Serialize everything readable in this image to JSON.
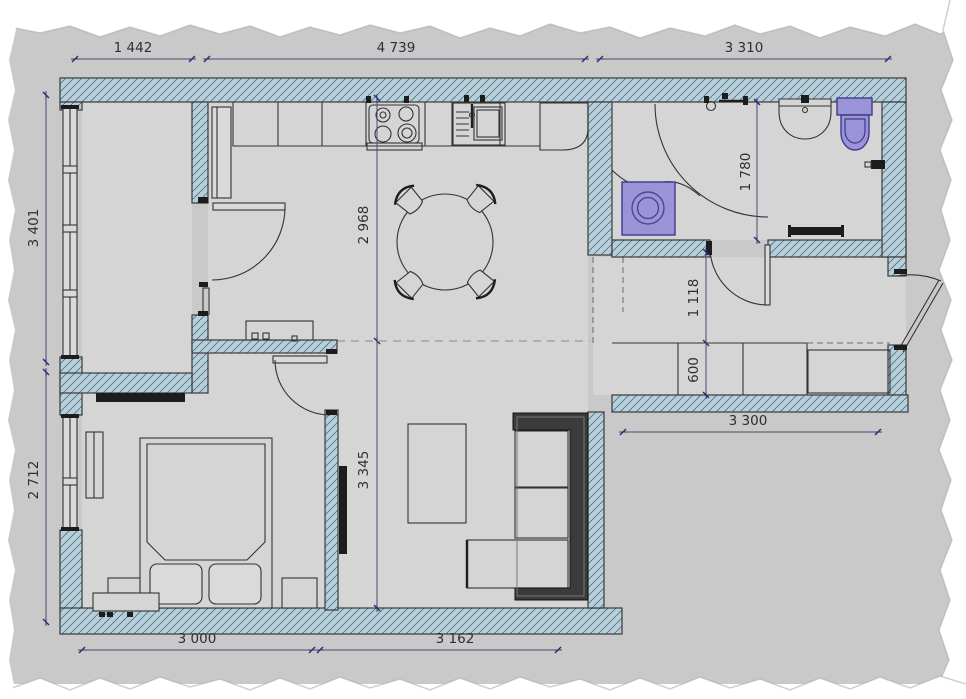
{
  "document": {
    "type": "apartment-floor-plan"
  },
  "colors": {
    "background": "#c9c9c9",
    "floor": "#d5d5d5",
    "wall_hatch": "#b7cedb",
    "wall_hatch_line": "#53707e",
    "wall_outline": "#3a3a3a",
    "fixture_purple": "#9b93d8",
    "fixture_purple_dark": "#3f3a8c",
    "dimension_line": "#4a4a6e",
    "dimension_text": "#2f2f2f",
    "paper_border": "#ffffff"
  },
  "dimensions": {
    "top": [
      "1 442",
      "4 739",
      "3 310"
    ],
    "left": [
      "3 401",
      "2 712"
    ],
    "bottom": [
      "3 000",
      "3 162"
    ],
    "interior": {
      "dining_zone_height": "2 968",
      "living_zone_height": "3 345",
      "hallway_width": "1 118",
      "wardrobe_depth": "600",
      "bathroom_depth": "1 780",
      "hallway_length": "3 300"
    }
  },
  "fixtures": [
    "window",
    "interior-door",
    "entrance-door",
    "kitchen-counter",
    "tall-cabinet",
    "stove",
    "kitchen-sink",
    "refrigerator",
    "dining-table",
    "chair",
    "washing-machine",
    "shower-mixer",
    "shower-curtain",
    "washbasin",
    "toilet",
    "towel-rail",
    "wardrobe",
    "coffee-table",
    "corner-sofa",
    "tv",
    "double-bed",
    "pillow",
    "nightstand",
    "bench",
    "radiator",
    "dresser"
  ]
}
